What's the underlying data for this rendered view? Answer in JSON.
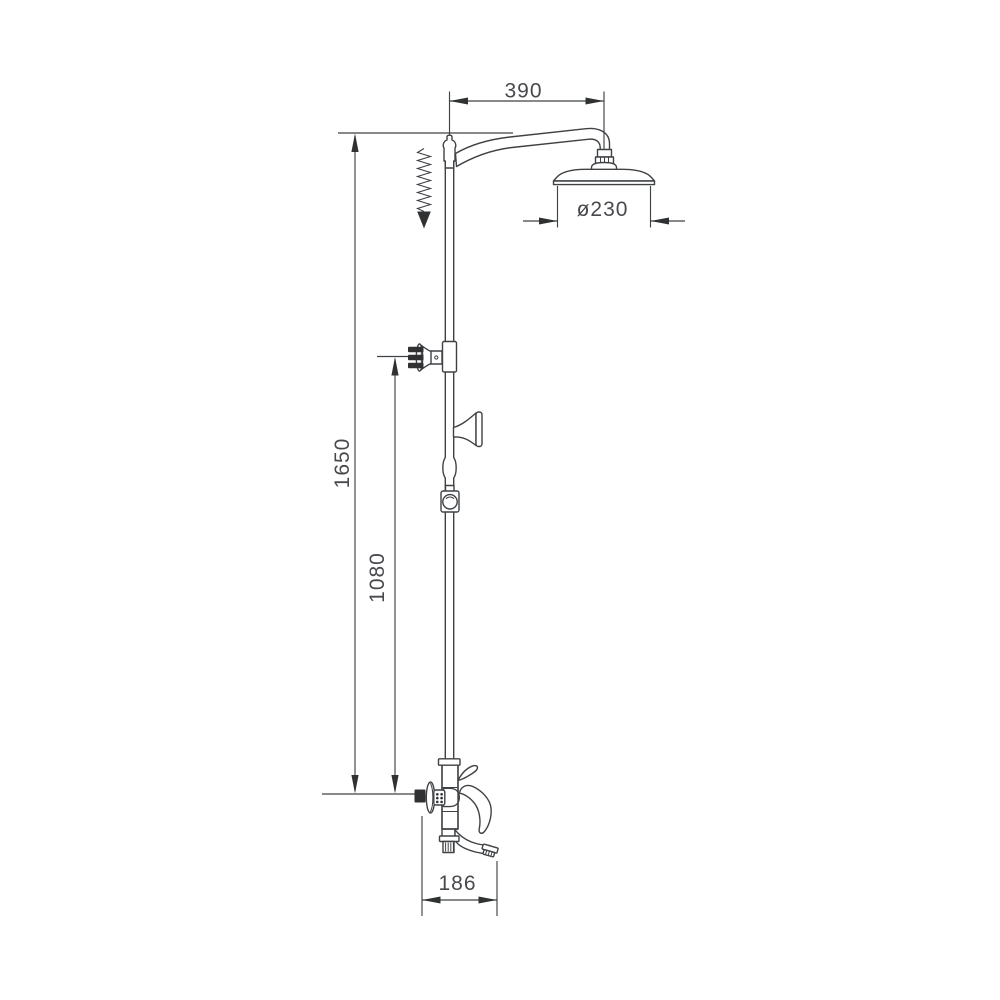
{
  "drawing": {
    "subject": "shower-column-mixer-technical-drawing",
    "background_color": "#ffffff",
    "line_color": "#3f4245",
    "solid_color": "#2f3133",
    "text_color": "#47494c"
  },
  "dimensions": [
    {
      "id": "arm-projection",
      "value": "390",
      "orientation": "horizontal"
    },
    {
      "id": "head-diameter",
      "value": "ø230",
      "orientation": "horizontal"
    },
    {
      "id": "total-height",
      "value": "1650",
      "orientation": "vertical"
    },
    {
      "id": "holder-height",
      "value": "1080",
      "orientation": "vertical"
    },
    {
      "id": "spout-projection",
      "value": "186",
      "orientation": "horizontal"
    }
  ]
}
